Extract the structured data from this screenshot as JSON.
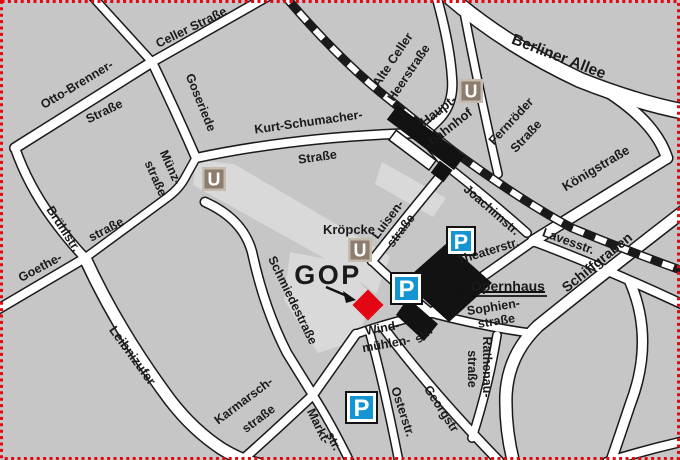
{
  "map": {
    "title": "GOP city map Hannover",
    "colors": {
      "background": "#c6c6c6",
      "pedestrian": "#d9d9d9",
      "street": "#ffffff",
      "outline": "#1a1a1a",
      "accent_red": "#e30613",
      "parking_blue": "#1495d2",
      "ubahn_taupe": "#8c7d6e",
      "ubahn_border": "#c6bcae"
    },
    "transit": {
      "u_symbol": "U",
      "p_symbol": "P",
      "ubahn_stations": [
        {
          "x": 202,
          "y": 167,
          "size": 24
        },
        {
          "x": 348,
          "y": 238,
          "size": 24
        },
        {
          "x": 459,
          "y": 79,
          "size": 24
        }
      ],
      "parking": [
        {
          "x": 446,
          "y": 226,
          "size": 30
        },
        {
          "x": 390,
          "y": 272,
          "size": 33
        },
        {
          "x": 345,
          "y": 391,
          "size": 33
        }
      ]
    },
    "pois": {
      "gop_label": "GOP",
      "opernhaus_label": "Opernhaus",
      "hauptbahnhof_label": "Haupt- bahnhof",
      "kroepcke_label": "Kröpcke"
    },
    "labels": [
      {
        "name": "celler-strasse",
        "text": "Celler Straße",
        "x": 193,
        "y": 31,
        "rot": -26
      },
      {
        "name": "otto-brenner-1",
        "text": "Otto-Brenner-",
        "x": 79,
        "y": 88,
        "rot": -31
      },
      {
        "name": "otto-brenner-2",
        "text": "Straße",
        "x": 106,
        "y": 115,
        "rot": -26
      },
      {
        "name": "goseriede",
        "text": "Goseriede",
        "x": 197,
        "y": 104,
        "rot": 68
      },
      {
        "name": "kurt-schumacher-1",
        "text": "Kurt-Schumacher-",
        "x": 309,
        "y": 126,
        "rot": -8
      },
      {
        "name": "kurt-schumacher-2",
        "text": "Straße",
        "x": 318,
        "y": 161,
        "rot": -8
      },
      {
        "name": "muenz-1",
        "text": "Münz-",
        "x": 167,
        "y": 169,
        "rot": 66
      },
      {
        "name": "muenz-2",
        "text": "straße",
        "x": 152,
        "y": 180,
        "rot": 66
      },
      {
        "name": "bruehlstr",
        "text": "Brühlstr.",
        "x": 60,
        "y": 231,
        "rot": 57
      },
      {
        "name": "goethe-1",
        "text": "Goethe-",
        "x": 42,
        "y": 271,
        "rot": -28
      },
      {
        "name": "goethe-2",
        "text": "straße",
        "x": 108,
        "y": 233,
        "rot": -28
      },
      {
        "name": "leibnizufer",
        "text": "Leibnizufer",
        "x": 129,
        "y": 358,
        "rot": 54,
        "size": 13
      },
      {
        "name": "schmiedestrasse",
        "text": "Schmiedestraße",
        "x": 289,
        "y": 302,
        "rot": 64
      },
      {
        "name": "karmarsch-1",
        "text": "Karmarsch-",
        "x": 246,
        "y": 404,
        "rot": -37
      },
      {
        "name": "karmarsch-2",
        "text": "straße",
        "x": 261,
        "y": 422,
        "rot": -37
      },
      {
        "name": "markt-1",
        "text": "Markt-",
        "x": 315,
        "y": 428,
        "rot": 64
      },
      {
        "name": "markt-2",
        "text": "str.",
        "x": 330,
        "y": 443,
        "rot": 64
      },
      {
        "name": "osterstr",
        "text": "Osterstr.",
        "x": 399,
        "y": 413,
        "rot": 72
      },
      {
        "name": "georgstr",
        "text": "Georgstr",
        "x": 438,
        "y": 411,
        "rot": 57
      },
      {
        "name": "wind-1",
        "text": "Wind-",
        "x": 383,
        "y": 332,
        "rot": -10
      },
      {
        "name": "wind-2",
        "text": "mühlen-",
        "x": 387,
        "y": 348,
        "rot": -10
      },
      {
        "name": "wind-3",
        "text": "str.",
        "x": 426,
        "y": 338,
        "rot": -38
      },
      {
        "name": "rathenau-1",
        "text": "Rathenau-",
        "x": 483,
        "y": 367,
        "rot": 90
      },
      {
        "name": "rathenau-2",
        "text": "straße",
        "x": 468,
        "y": 369,
        "rot": 90
      },
      {
        "name": "sophien-1",
        "text": "Sophien-",
        "x": 494,
        "y": 311,
        "rot": -9
      },
      {
        "name": "sophien-2",
        "text": "straße",
        "x": 497,
        "y": 325,
        "rot": -9
      },
      {
        "name": "theaterstr",
        "text": "Theaterstr.",
        "x": 489,
        "y": 255,
        "rot": -17
      },
      {
        "name": "lavesstr",
        "text": "Lavesstr.",
        "x": 567,
        "y": 245,
        "rot": 20
      },
      {
        "name": "koenigstrasse",
        "text": "Königstraße",
        "x": 598,
        "y": 172,
        "rot": -31,
        "size": 13
      },
      {
        "name": "schiffgraben",
        "text": "Schiffgraben",
        "x": 600,
        "y": 266,
        "rot": -39,
        "size": 14
      },
      {
        "name": "joachimstr",
        "text": "Joachimstr.",
        "x": 489,
        "y": 213,
        "rot": 41
      },
      {
        "name": "fernroeder-1",
        "text": "Fernröder",
        "x": 514,
        "y": 124,
        "rot": -47
      },
      {
        "name": "fernroeder-2",
        "text": "Straße",
        "x": 529,
        "y": 139,
        "rot": -47
      },
      {
        "name": "alte-celler-1",
        "text": "Alte Celler",
        "x": 396,
        "y": 62,
        "rot": -56
      },
      {
        "name": "alte-celler-2",
        "text": "Heerstraße",
        "x": 412,
        "y": 75,
        "rot": -56
      },
      {
        "name": "berliner-allee",
        "text": "Berliner Allee",
        "x": 557,
        "y": 61,
        "rot": 21,
        "size": 15.5
      },
      {
        "name": "luisen-1",
        "text": "Luisen-",
        "x": 391,
        "y": 222,
        "rot": -53
      },
      {
        "name": "luisen-2",
        "text": "straße",
        "x": 404,
        "y": 233,
        "rot": -53
      },
      {
        "name": "kroepcke",
        "text": "Kröpcke",
        "x": 349,
        "y": 234,
        "rot": 0,
        "size": 13
      },
      {
        "name": "hauptbahnhof-1",
        "text": "Haupt-",
        "x": 441,
        "y": 114,
        "rot": -38,
        "color": "#e30613",
        "size": 13
      },
      {
        "name": "hauptbahnhof-2",
        "text": "bahnhof",
        "x": 453,
        "y": 130,
        "rot": -38,
        "color": "#e30613",
        "size": 13
      },
      {
        "name": "gop",
        "text": "GOP",
        "x": 328,
        "y": 284,
        "rot": 0,
        "size": 27,
        "color": "#e30613",
        "spacing": 2.5
      },
      {
        "name": "opernhaus",
        "text": "Opernhaus",
        "x": 508,
        "y": 291,
        "rot": 0,
        "size": 14
      }
    ]
  }
}
